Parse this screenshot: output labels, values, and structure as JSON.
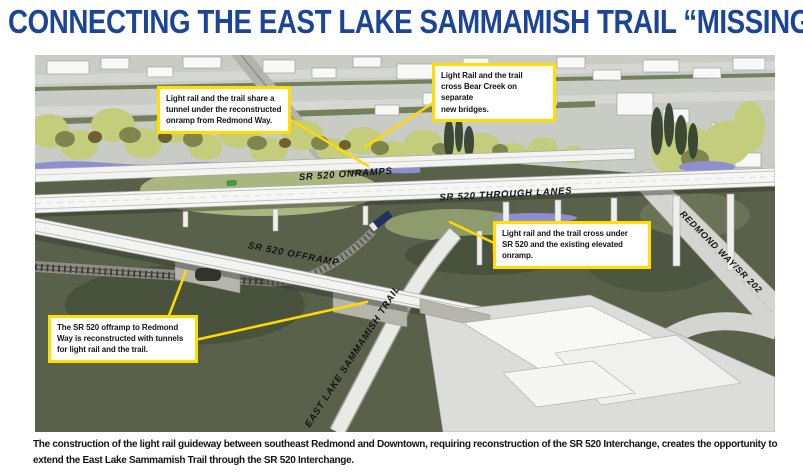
{
  "title": "CONNECTING THE EAST LAKE SAMMAMISH TRAIL “MISSING LINK”",
  "colors": {
    "title_blue": "#1B4697",
    "callout_yellow": "#FFDE00",
    "grass_dark": "#59614B",
    "tree_green": "#C3CD7C",
    "water_blue": "#8E8ED0"
  },
  "callouts": [
    {
      "id": "tunnel-onramp",
      "text": "Light rail and the trail share a\ntunnel under the reconstructed\nonramp from Redmond Way."
    },
    {
      "id": "bear-creek",
      "text": "Light Rail and the trail\ncross Bear Creek on separate\nnew bridges."
    },
    {
      "id": "cross-under",
      "text": "Light rail and the trail cross under\nSR 520 and the existing elevated\nonramp."
    },
    {
      "id": "offramp-tunnels",
      "text": "The SR 520 offramp to Redmond\nWay is reconstructed with tunnels\nfor light rail and the trail."
    }
  ],
  "road_labels": {
    "onramps": "SR 520 ONRAMPS",
    "through_lanes": "SR 520 THROUGH LANES",
    "offramp": "SR 520 OFFRAMP",
    "trail": "EAST LAKE SAMMAMISH TRAIL",
    "redmond_way": "REDMOND WAY/SR 202"
  },
  "caption": "The construction of the light rail guideway between southeast Redmond and Downtown, requiring reconstruction of the SR 520 Interchange, creates the opportunity to extend the East Lake Sammamish Trail through the SR 520 Interchange."
}
